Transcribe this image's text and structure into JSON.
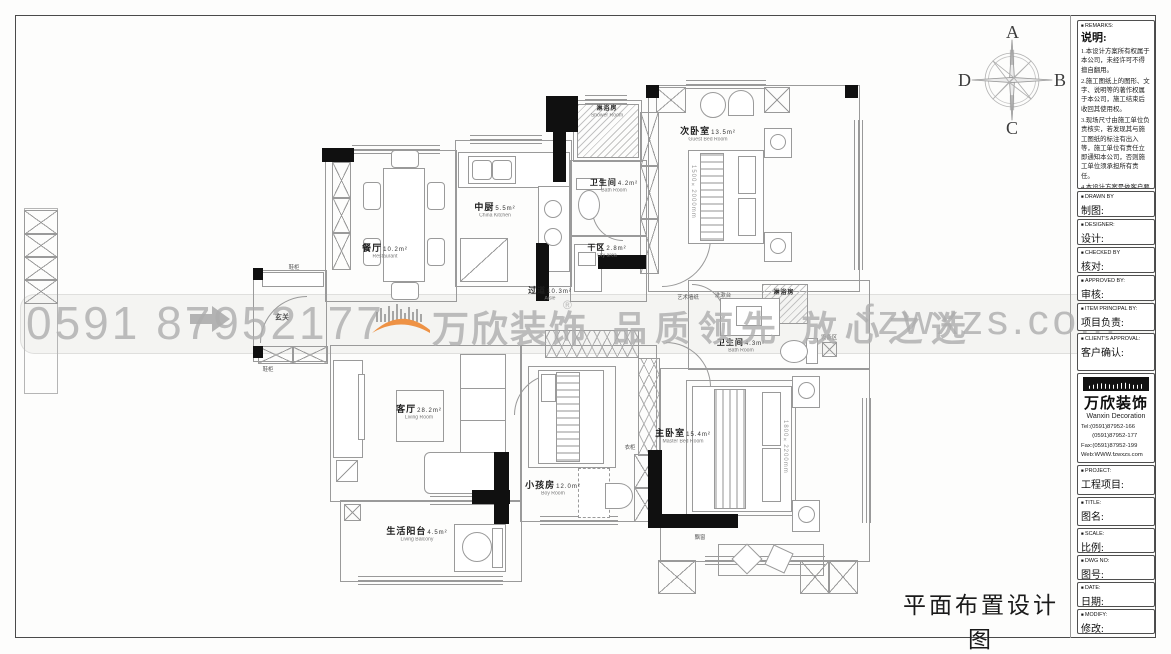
{
  "page": {
    "sheet_title": "平面布置设计图"
  },
  "compass": {
    "top": "A",
    "right": "B",
    "bottom": "C",
    "left": "D"
  },
  "watermark": {
    "phone": "0591 87952177",
    "brand": "万欣装饰",
    "reg": "®",
    "slogan": "品质领先 放心之选",
    "site": "fzwxzs.com"
  },
  "rooms": {
    "dining": {
      "cn": "餐厅",
      "area": "10.2m²",
      "en": "Restaurant"
    },
    "kitchen": {
      "cn": "中厨",
      "area": "5.5m²",
      "en": "China Kitchen"
    },
    "shower_top": {
      "cn": "淋浴房",
      "en": "Shower Room"
    },
    "bath_top": {
      "cn": "卫生间",
      "area": "4.2m²",
      "en": "Bath Room"
    },
    "dry": {
      "cn": "干区",
      "area": "2.8m²",
      "en": "Dry area"
    },
    "guest": {
      "cn": "次卧室",
      "area": "13.5m²",
      "en": "Guest Bed Room"
    },
    "aisle": {
      "cn": "过道",
      "area": "10.3m²",
      "en": "Aisle"
    },
    "living": {
      "cn": "客厅",
      "area": "28.2m²",
      "en": "Living Room"
    },
    "boy": {
      "cn": "小孩房",
      "area": "12.0m²",
      "en": "Boy Room"
    },
    "master": {
      "cn": "主卧室",
      "area": "15.4m²",
      "en": "Master Bed Room"
    },
    "mbath": {
      "cn": "卫生间",
      "area": "4.3m²",
      "en": "Bath Room"
    },
    "mshower": {
      "cn": "淋浴房",
      "en": "Shower Room"
    },
    "balcony": {
      "cn": "生活阳台",
      "area": "4.5m²",
      "en": "Living Balcony"
    }
  },
  "small_labels": {
    "entry": "玄关",
    "shoe": "鞋柜",
    "wardrobe": "衣柜",
    "bay": "飘窗",
    "equipment": "设备区",
    "art_wall": "艺术墙纸",
    "wash_stand": "洗漱台"
  },
  "bed_dims": {
    "guest": "1500×2000mm",
    "master": "1800×2200mm"
  },
  "titleblock": {
    "remarks": {
      "en": "REMARKS:",
      "cn": "说明:",
      "items": [
        "1.本设计方案所有权属于本公司，未经许可不得擅自翻用。",
        "2.施工图纸上的图形、文字、说明等的著作权属于本公司，施工结束后收回其使用权。",
        "3.现场尺寸由施工单位负责核实，若发现其与施工图纸的标注有出入等，施工单位有责任立即通知本公司，否则施工单位须承担所有责任。",
        "4.本设计方案是依客户要求设计，经客户签字即视为同意认可，不得随意更改。"
      ]
    },
    "fields": [
      {
        "en": "DRAWN BY",
        "cn": "制图:"
      },
      {
        "en": "DESIGNER:",
        "cn": "设计:"
      },
      {
        "en": "CHECKED BY",
        "cn": "核对:"
      },
      {
        "en": "APPROVED BY:",
        "cn": "审核:"
      },
      {
        "en": "ITEM PRINCIPAL BY:",
        "cn": "项目负责:"
      },
      {
        "en": "CLIENT'S APPROVAL:",
        "cn": "客户确认:"
      }
    ],
    "company": {
      "logo_cn": "万欣装饰",
      "logo_en": "Wanxin Decoration",
      "tel1": "Tel:(0591)87952-166",
      "tel2": "(0591)87952-177",
      "fax": "Fax:(0591)87952-199",
      "web": "Web:WWW.fzwxzs.com"
    },
    "fields2": [
      {
        "en": "PROJECT:",
        "cn": "工程项目:"
      },
      {
        "en": "TITLE:",
        "cn": "图名:"
      },
      {
        "en": "SCALE:",
        "cn": "比例:"
      },
      {
        "en": "DWG NO:",
        "cn": "图号:"
      },
      {
        "en": "DATE:",
        "cn": "日期:"
      },
      {
        "en": "MODIFY:",
        "cn": "修改:"
      }
    ]
  }
}
